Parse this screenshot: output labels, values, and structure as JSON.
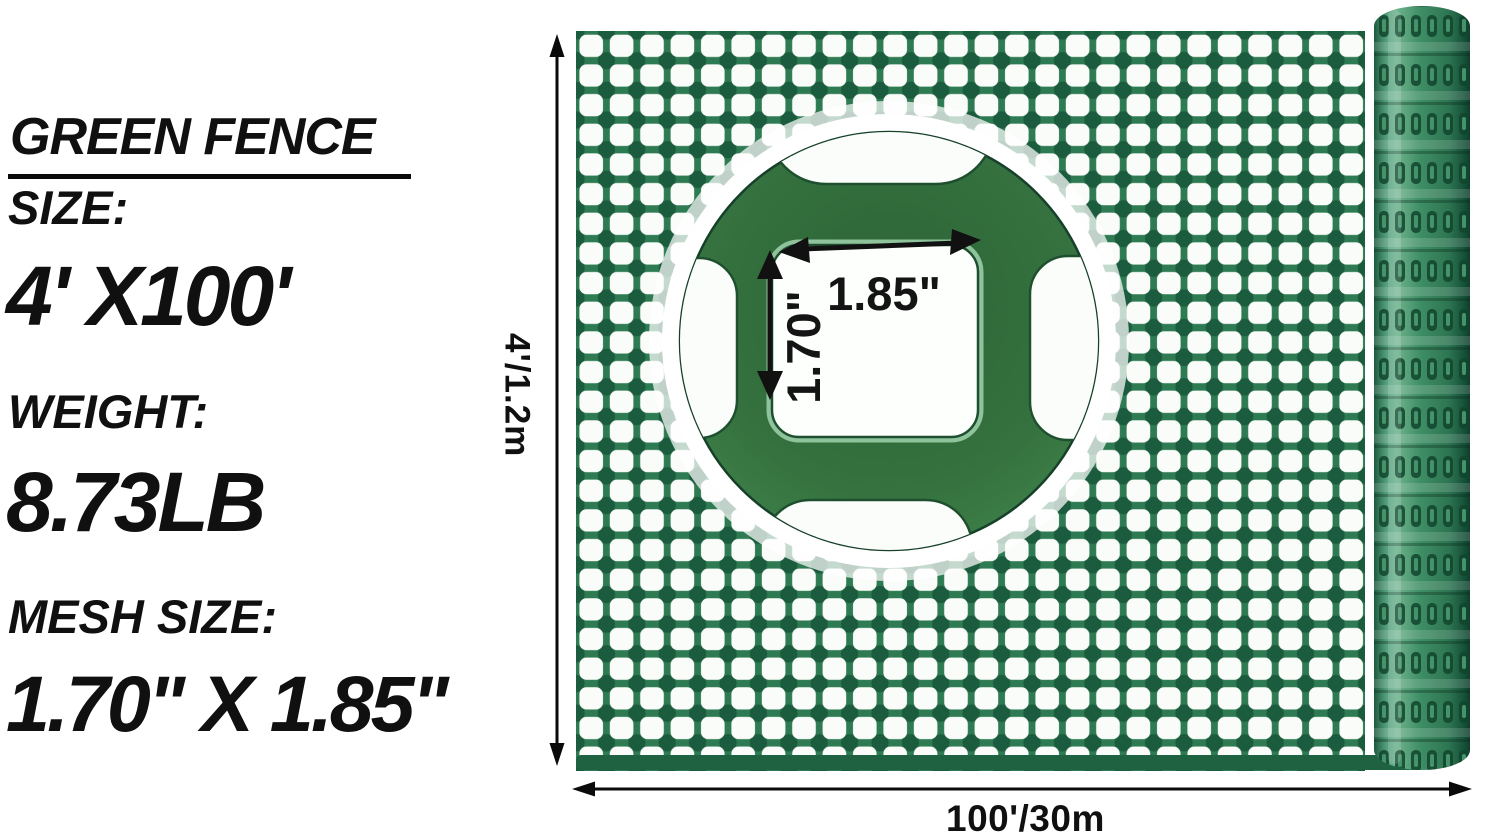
{
  "specs": {
    "title": "GREEN FENCE",
    "size_label": "SIZE:",
    "size_value": "4' X100'",
    "weight_label": "WEIGHT:",
    "weight_value": "8.73LB",
    "mesh_label": "MESH SIZE:",
    "mesh_value": "1.70\" X 1.85\""
  },
  "dimensions": {
    "height": "4'/1.2m",
    "length": "100'/30m"
  },
  "inset": {
    "mesh_width": "1.85\"",
    "mesh_height": "1.70\""
  },
  "colors": {
    "mesh_strand_green": "#2e7a52",
    "mesh_joint_green": "#1a5c3d",
    "mesh_hole_white": "#fafcf9",
    "inset_green": "#35723f",
    "roll_green": "#3f8e65",
    "arrow_black": "#111111",
    "text_black": "#0a0a0a"
  }
}
